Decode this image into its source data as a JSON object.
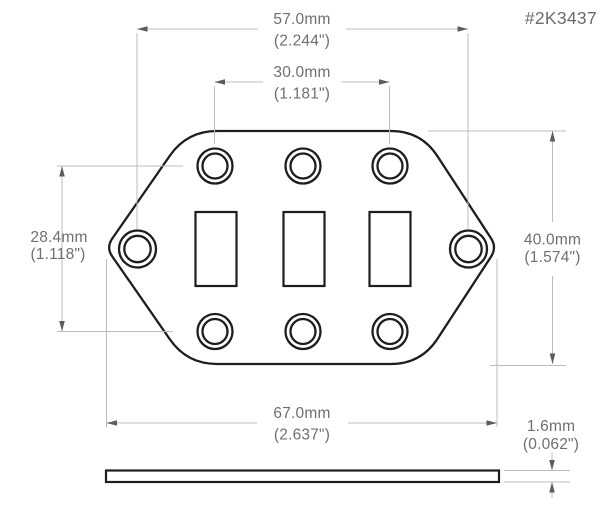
{
  "part_number": "#2K3437",
  "colors": {
    "outline": "#1e1e1e",
    "dimension_lines": "#bcbcbc",
    "arrows": "#5c5c5c",
    "text": "#6f6f6f",
    "background": "#ffffff"
  },
  "dimensions": {
    "hole_span_width": {
      "mm": "57.0mm",
      "inch": "(2.244\")"
    },
    "slot_span_width": {
      "mm": "30.0mm",
      "inch": "(1.181\")"
    },
    "hole_row_spacing": {
      "mm": "28.4mm",
      "inch": "(1.118\")"
    },
    "plate_height": {
      "mm": "40.0mm",
      "inch": "(1.574\")"
    },
    "overall_width": {
      "mm": "67.0mm",
      "inch": "(2.637\")"
    },
    "thickness": {
      "mm": "1.6mm",
      "inch": "(0.062\")"
    }
  }
}
